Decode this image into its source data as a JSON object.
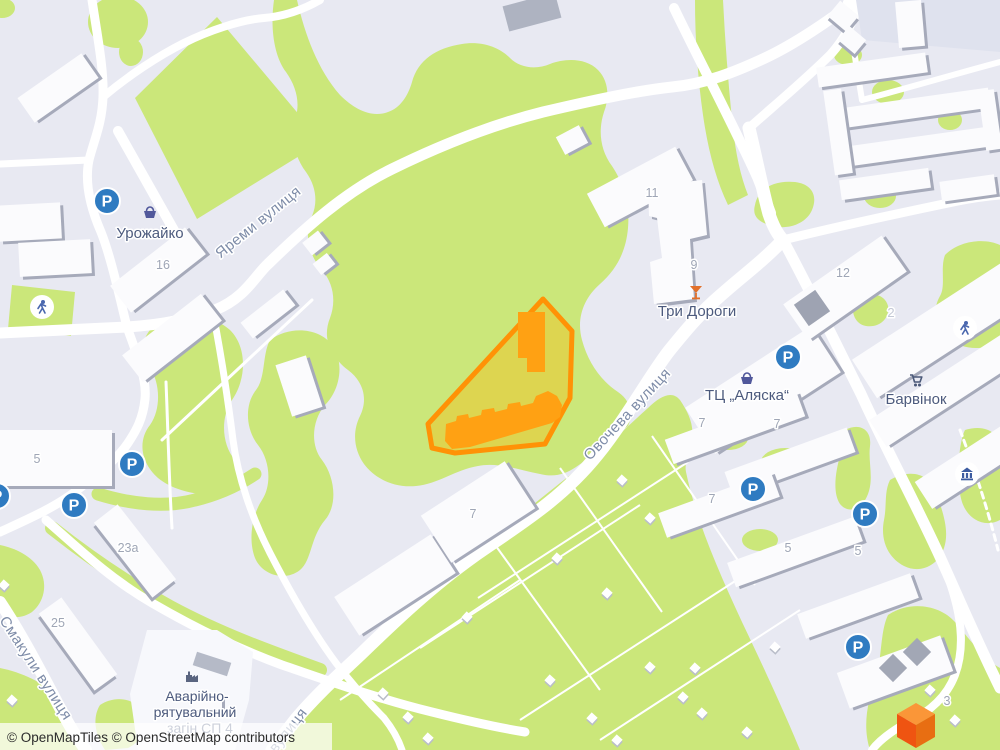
{
  "map": {
    "attribution": "© OpenMapTiles © OpenStreetMap contributors",
    "streets": {
      "yaremy": "Яреми вулиця",
      "ovocheva": "Овочева вулиця",
      "smakuly": "Смакули вулиця",
      "partial": "вулиця"
    },
    "places": {
      "urozhaiko": "Урожайко",
      "try_dorohy": "Три Дороги",
      "alaska": "ТЦ „Аляска“",
      "barvinok": "Барвінок",
      "rescue_line1": "Аварійно-",
      "rescue_line2": "рятувальний",
      "rescue_line3": "загін СП 4"
    },
    "house_numbers": [
      "16",
      "11",
      "9",
      "12",
      "2",
      "5",
      "23а",
      "25",
      "7",
      "7",
      "7",
      "7",
      "5",
      "5",
      "3"
    ],
    "parking": "P",
    "icons": [
      "parking-icon",
      "playground-icon",
      "museum-icon",
      "shop-basket-icon",
      "bar-cocktail-icon",
      "supermarket-cart-icon",
      "factory-icon"
    ],
    "colors": {
      "background": "#e8e9f2",
      "green": "#cbe77a",
      "road": "#ffffff",
      "building": "#fbfbfd",
      "building_shadow": "#a6aaba",
      "selection_stroke": "#ff9206",
      "selection_fill": "#ffb300",
      "selection_building": "#ffa113",
      "parking_blue": "#2f7bc1",
      "place_label": "#4c5a7d",
      "street_label": "#7e8ca8",
      "logo_orange": "#ef5411"
    }
  }
}
